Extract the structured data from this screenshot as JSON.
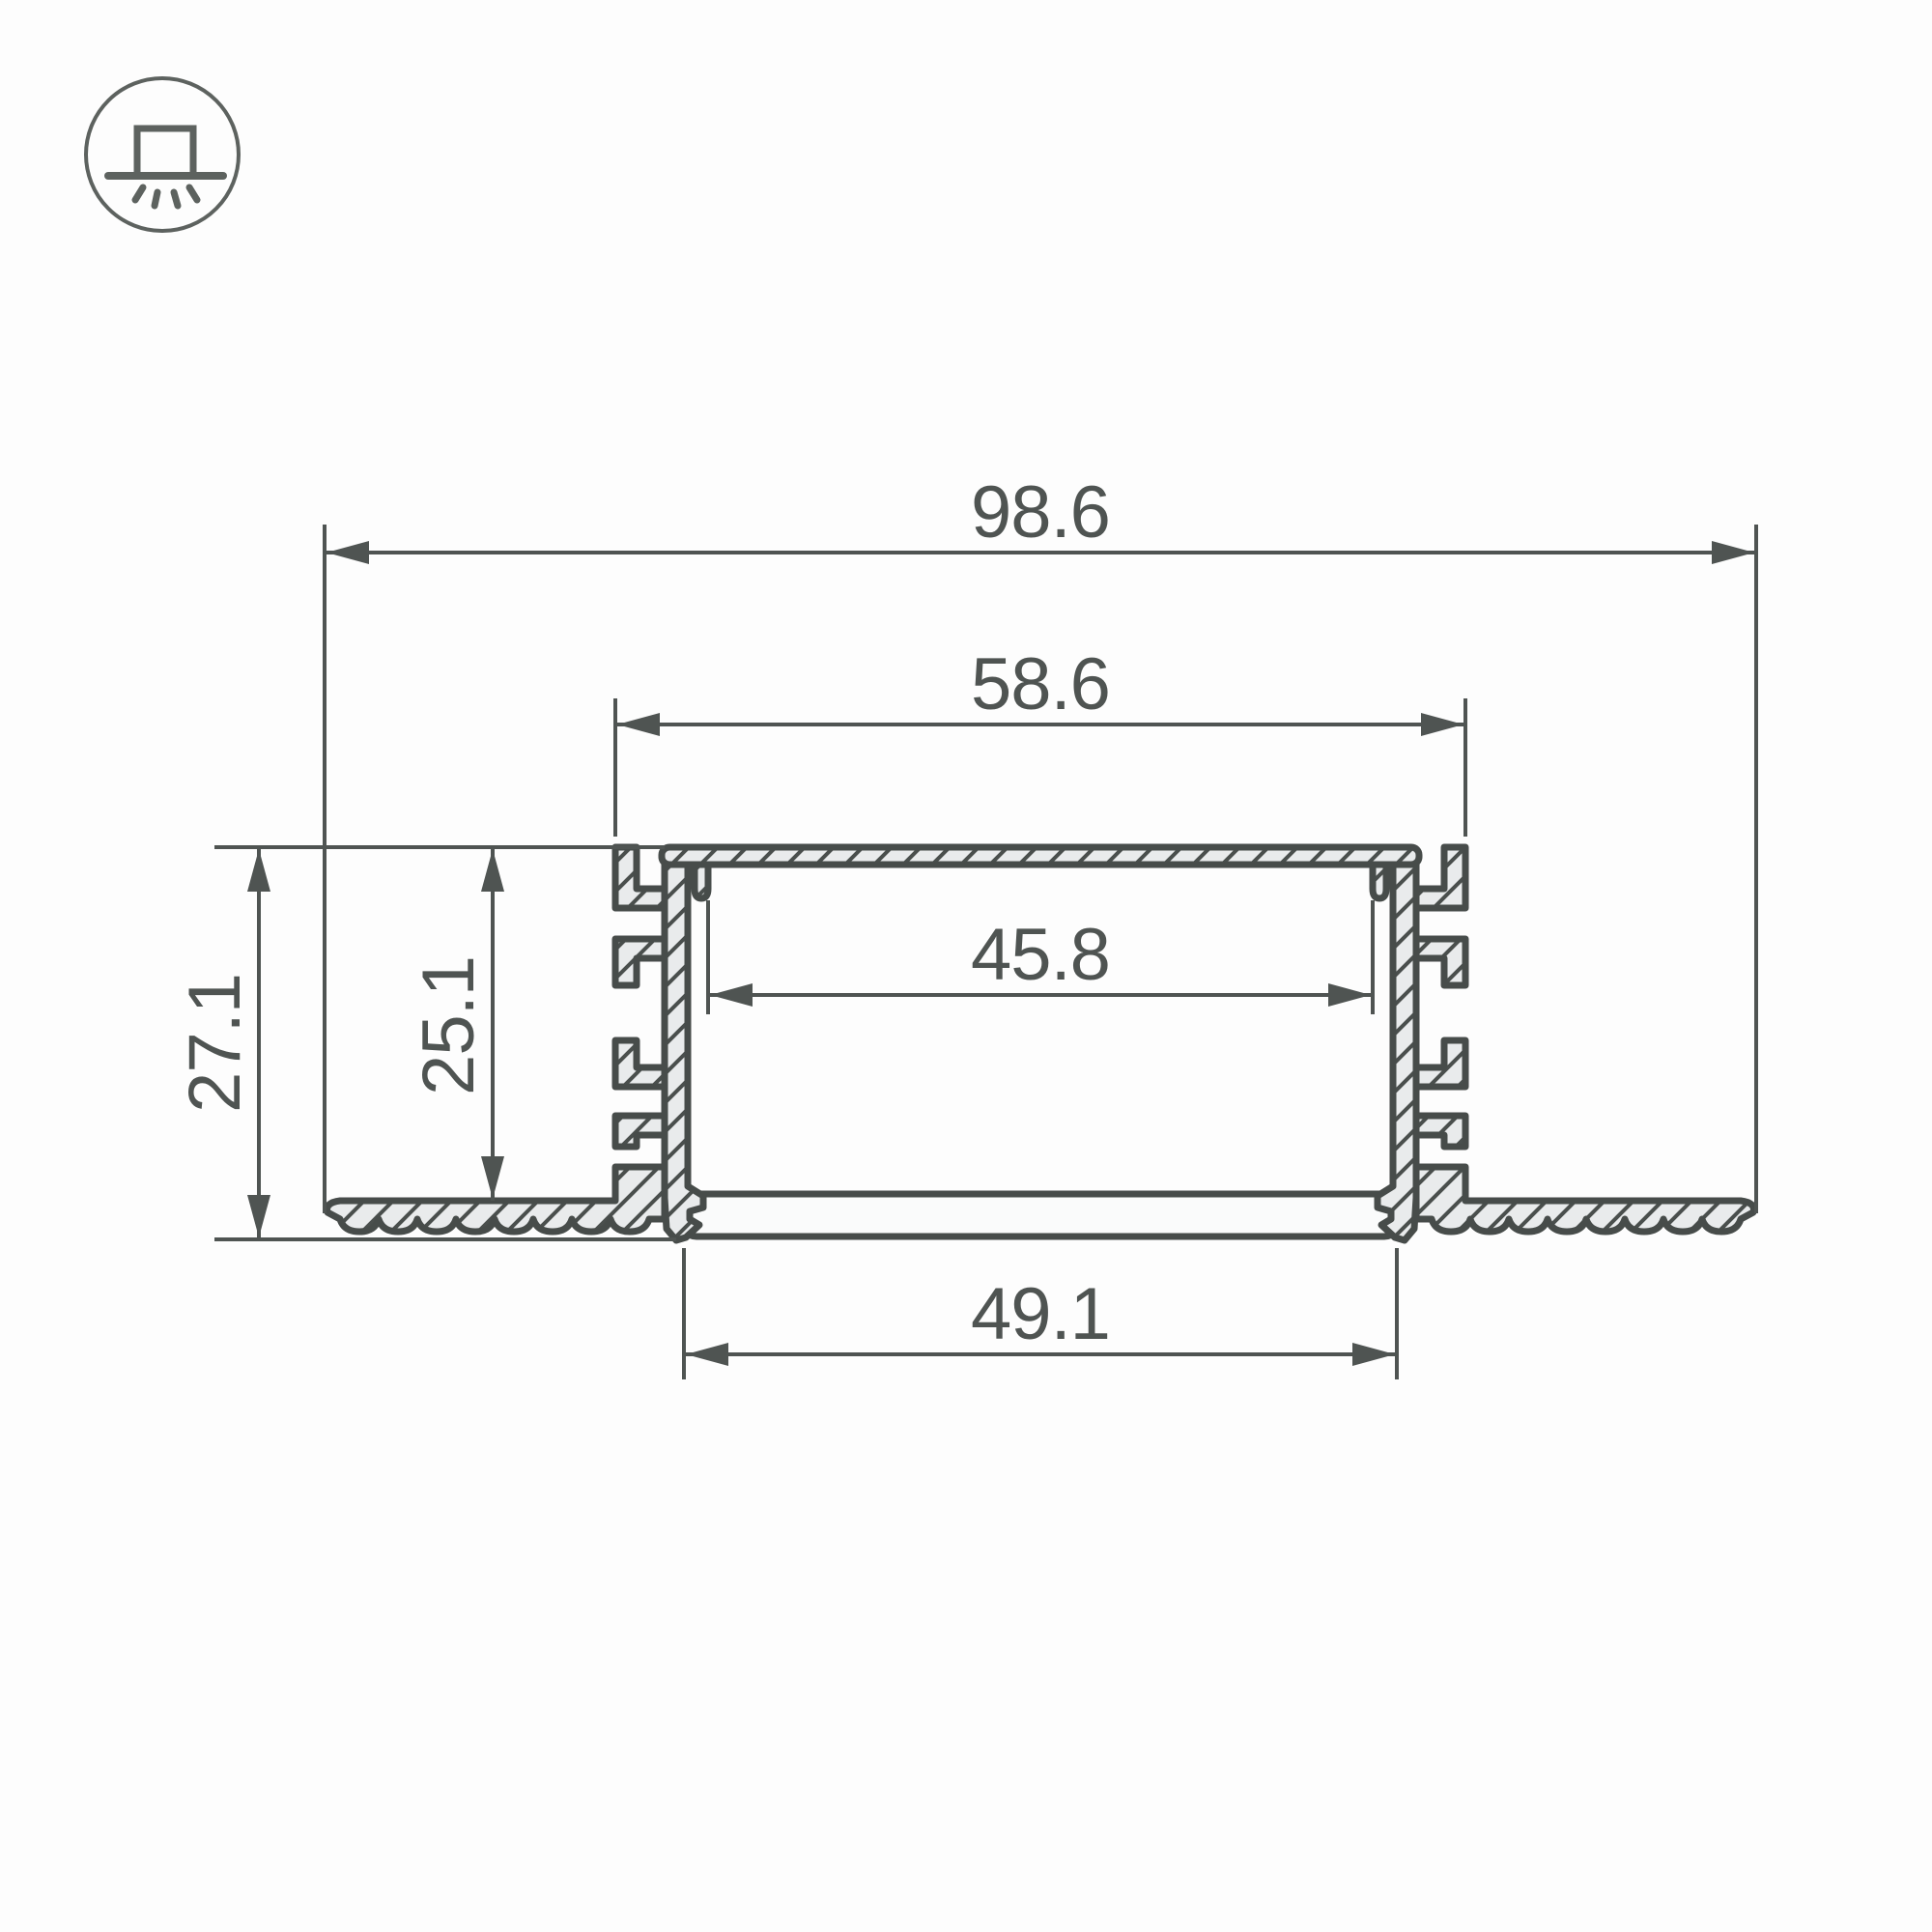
{
  "page": {
    "background": "#fdfdfd",
    "kind": "technical-drawing"
  },
  "colors": {
    "line": "#4f5452",
    "outline": "#474c4a",
    "fill": "#e9ebec",
    "diffuser": "#fafbfb",
    "background": "#fdfdfd",
    "icon": "#5d625f"
  },
  "icon": {
    "name": "recessed-mount"
  },
  "drawing": {
    "dimensions": {
      "overall_width": "98.6",
      "mounting_width": "58.6",
      "inner_width": "45.8",
      "diffuser_width": "49.1",
      "overall_height": "27.1",
      "recess_depth": "25.1"
    }
  }
}
